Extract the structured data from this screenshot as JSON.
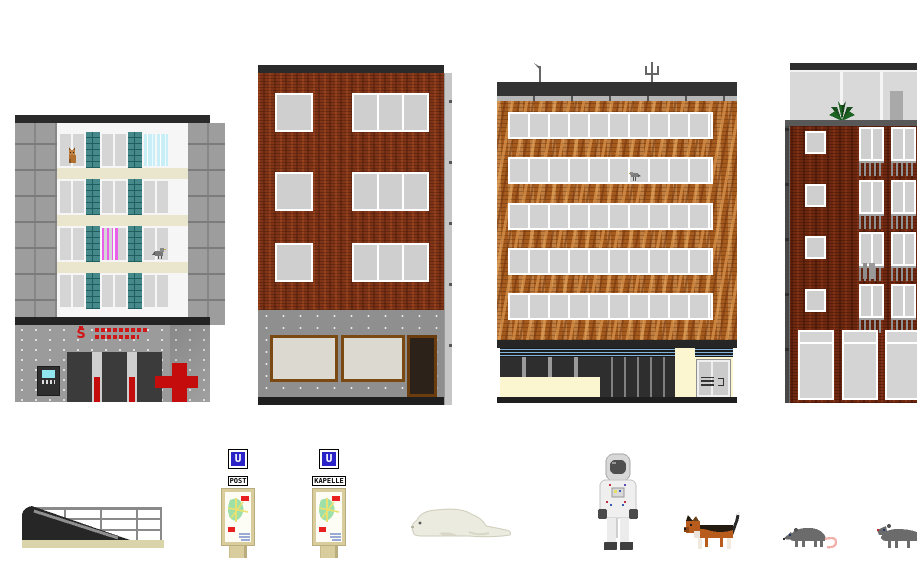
{
  "app": {
    "title": "Pixel-art city sprite sheet"
  },
  "signs": {
    "post": {
      "logo": "U",
      "label": "POST"
    },
    "kapelle": {
      "logo": "U",
      "label": "KAPELLE"
    }
  },
  "bank": {
    "logo_letter": "S",
    "brand": "Sparkasse",
    "sign_color": "#d01616"
  },
  "buildings": {
    "bank": {
      "floors": 4,
      "windows_per_floor": 6,
      "glass_block_columns": 2,
      "ground": [
        "atm",
        "three-dark-doors",
        "red-cross"
      ]
    },
    "brick_shop": {
      "floors": 3,
      "windows_per_floor": 2,
      "storefront_windows": 2,
      "doors": 1
    },
    "office": {
      "floors": 5,
      "ribbon_window_bands": 5,
      "roof_antennas": 2,
      "ground": [
        "shop-windows",
        "glass-door",
        "gray-door-with-intercom"
      ]
    },
    "apartments": {
      "floors": 4,
      "balconies_per_floor": 2,
      "small_windows": 4,
      "ground_windows": 3,
      "roof": [
        "glass-penthouse",
        "plant",
        "chimney-box"
      ]
    }
  },
  "sprites": {
    "list": [
      "subway-entrance",
      "u-sign-post",
      "u-sign-kapelle",
      "seal",
      "astronaut",
      "dog",
      "rat",
      "rat-cropped",
      "cat-in-window",
      "pigeon",
      "bird",
      "roof-plant"
    ]
  },
  "palette": {
    "charcoal": "#2a2a2a",
    "stone_gray": "#9d9d9d",
    "cream_band": "#e9e6cd",
    "teal_glass": "#45898a",
    "cyan_window": "#c9eef7",
    "pink_graffiti": "#e95fe9",
    "sparkasse_red": "#d01616",
    "pharmacy_red": "#c40c0c",
    "brick_red": "#7d3317",
    "brick_orange": "#a55a1e",
    "brick_dark_red": "#6e2810",
    "ubahn_blue": "#2a24c8",
    "map_green": "#9fe0a8",
    "map_yellow": "#e8e070",
    "sand_ground": "#d9d4a9",
    "rat_gray": "#6b6b6b",
    "rat_tail_pink": "#f2b0aa",
    "dog_orange": "#b85c1e"
  }
}
